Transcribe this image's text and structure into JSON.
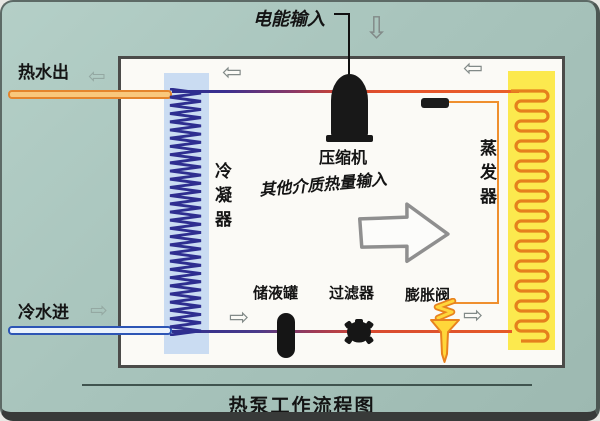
{
  "title": "热泵工作流程图",
  "labels": {
    "electric_input": "电能输入",
    "compressor": "压缩机",
    "heat_input": "其他介质热量输入",
    "condenser": "冷凝器",
    "evaporator": "蒸发器",
    "receiver_tank": "储液罐",
    "filter": "过滤器",
    "expansion_valve": "膨胀阀",
    "hot_water_out": "热水出",
    "cold_water_in": "冷水进"
  },
  "icons": {
    "arrow_left": "⇦",
    "arrow_right": "⇨",
    "arrow_down": "⇩"
  },
  "colors": {
    "background_teal": "#a8c4bc",
    "diagram_box": "#fbfaf6",
    "condenser_strip": "#cadcf2",
    "condenser_coil": "#2e2e90",
    "evaporator_strip": "#fce94e",
    "evaporator_coil": "#e5801d",
    "pipe_cold_end": "#2e2e8e",
    "pipe_hot_end": "#e65b28",
    "hot_water_pipe": "#e4852c",
    "cold_water_pipe": "#2d55b5",
    "capillary_tube": "#ef8f2e",
    "valve_fill": "#ffd63a",
    "valve_stroke": "#e8821e",
    "component_black": "#181818",
    "arrow_gray": "#8a8a8a"
  }
}
